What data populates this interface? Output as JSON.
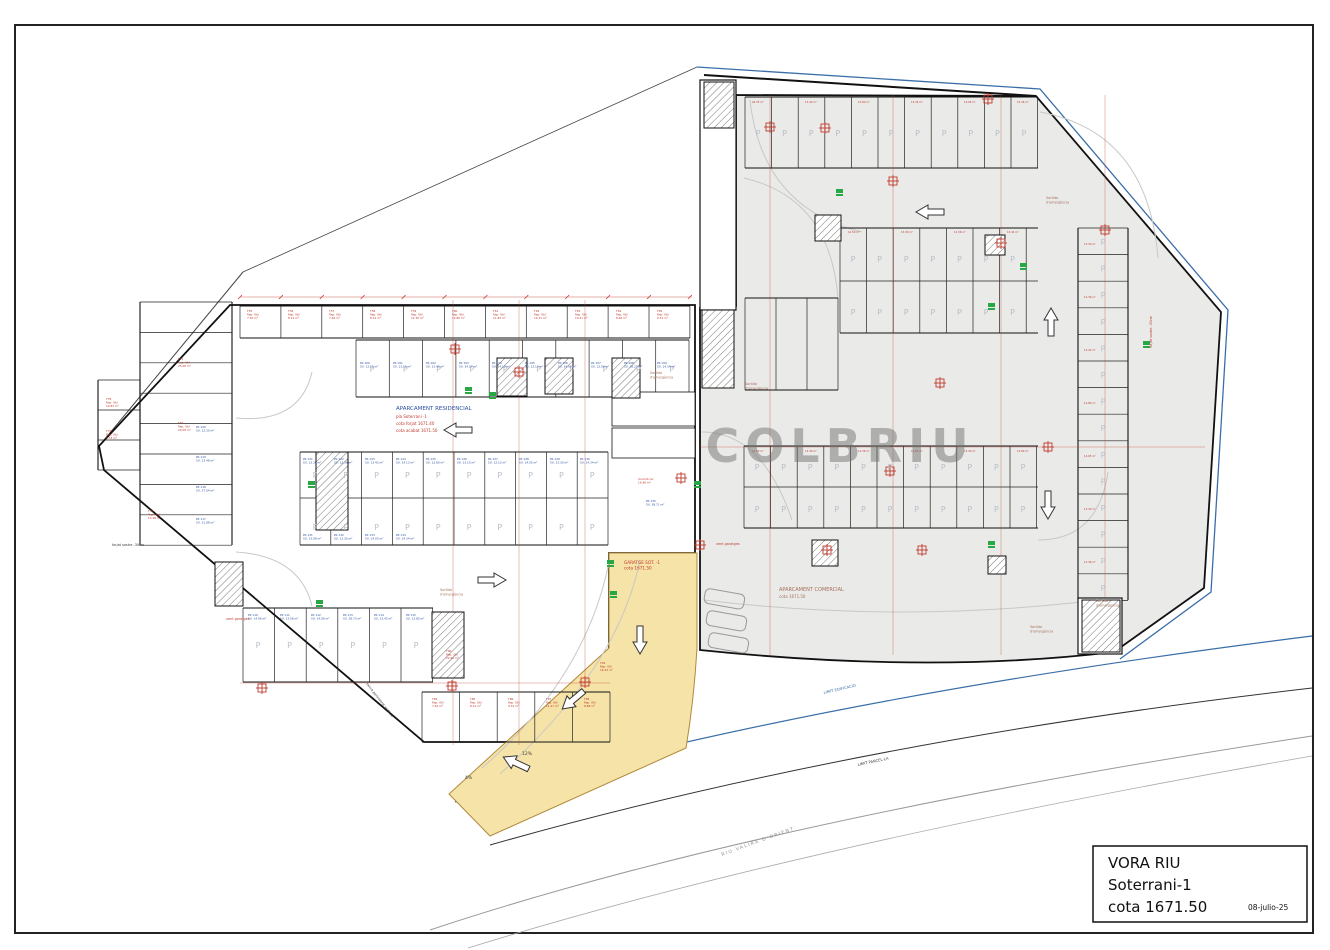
{
  "colors": {
    "blue": "#2a4fa0",
    "red": "#c03a2e",
    "brownred": "#a6705c",
    "gray": "#8f8f8f",
    "siteblue": "#3a6ea8",
    "dark": "#3a3a3a",
    "green": "#27a844",
    "ramp_yellow": "#f6e3a8",
    "commercial_fill": "#eaeae8",
    "watermark_gray": "#6f6f6f"
  },
  "title_block": {
    "project": "VORA RIU",
    "level": "Soterrani-1",
    "elevation": "cota 1671.50",
    "date": "08-julio-25"
  },
  "watermark": "COLBRIU",
  "stall_letter": "P",
  "labels": [
    {
      "n": "residential-area-title",
      "x": 396,
      "y": 410,
      "s": 5.5,
      "c": "blue",
      "L": [
        "APARCAMENT RESIDENCIAL"
      ]
    },
    {
      "n": "residential-area-plan",
      "x": 396,
      "y": 418,
      "s": 4,
      "c": "red",
      "L": [
        "pla Soterrani -1"
      ]
    },
    {
      "n": "residential-cota-forjat",
      "x": 396,
      "y": 425,
      "s": 4,
      "c": "red",
      "L": [
        "cota forjat 1671.40"
      ]
    },
    {
      "n": "residential-cota-acabat",
      "x": 396,
      "y": 432,
      "s": 4,
      "c": "red",
      "L": [
        "cota acabat 1671.50"
      ]
    },
    {
      "n": "commercial-area-title",
      "x": 779,
      "y": 591,
      "s": 5,
      "c": "brownred",
      "L": [
        "APARCAMENT COMERCIAL"
      ]
    },
    {
      "n": "commercial-area-cota",
      "x": 779,
      "y": 598,
      "s": 4,
      "c": "brownred",
      "L": [
        "cota 1671.50"
      ]
    },
    {
      "n": "ramp-area-title",
      "x": 624,
      "y": 564,
      "s": 4.2,
      "c": "red",
      "L": [
        "GARATGE SOT. -1",
        "cota 1671.50"
      ]
    },
    {
      "n": "exit-label",
      "x": 650,
      "y": 374,
      "s": 3.4,
      "c": "brownred",
      "L": [
        "Sortida",
        "d'emergència"
      ]
    },
    {
      "n": "exit-label",
      "x": 745,
      "y": 385,
      "s": 3.4,
      "c": "brownred",
      "L": [
        "Sortida",
        "d'emergència"
      ]
    },
    {
      "n": "exit-label",
      "x": 1046,
      "y": 199,
      "s": 3.4,
      "c": "brownred",
      "L": [
        "Sortida",
        "d'emergència"
      ]
    },
    {
      "n": "exit-label",
      "x": 1030,
      "y": 628,
      "s": 3.4,
      "c": "brownred",
      "L": [
        "Sortida",
        "d'emergència"
      ]
    },
    {
      "n": "exit-label",
      "x": 440,
      "y": 591,
      "s": 3.4,
      "c": "brownred",
      "L": [
        "Sortida",
        "d'emergència"
      ]
    },
    {
      "n": "exit-label",
      "x": 1096,
      "y": 602,
      "s": 3.4,
      "c": "brownred",
      "L": [
        "Sortida",
        "d'emergència"
      ]
    },
    {
      "n": "vent-label",
      "x": 716,
      "y": 545,
      "s": 3.4,
      "c": "red",
      "L": [
        "vent garatges"
      ]
    },
    {
      "n": "vent-label",
      "x": 226,
      "y": 620,
      "s": 3.4,
      "c": "red",
      "L": [
        "vent garatges"
      ]
    },
    {
      "n": "slab-note",
      "x": 112,
      "y": 546,
      "s": 3.4,
      "c": "dark",
      "L": [
        "forjat sostre -30cm"
      ]
    },
    {
      "n": "slab-note",
      "x": 1152,
      "y": 348,
      "s": 3.4,
      "c": "red",
      "r": -90,
      "L": [
        "forjat sostre -30cm"
      ]
    },
    {
      "n": "fence-note",
      "x": 366,
      "y": 684,
      "s": 3.4,
      "c": "dark",
      "r": 52,
      "L": [
        "tanca perimetral vertical"
      ]
    },
    {
      "n": "river-label",
      "x": 722,
      "y": 856,
      "s": 4.6,
      "c": "gray",
      "r": -20,
      "sp": 1.5,
      "L": [
        "RIU  VALIRA  D'ORIENT"
      ]
    },
    {
      "n": "limit-edificacio-label",
      "x": 824,
      "y": 694,
      "s": 3.8,
      "c": "siteblue",
      "r": -13,
      "L": [
        "LIMIT EDIFICACIO"
      ]
    },
    {
      "n": "limit-parcella-label",
      "x": 858,
      "y": 766,
      "s": 3.8,
      "c": "dark",
      "r": -12,
      "L": [
        "LIMIT PARCEL·LA"
      ]
    },
    {
      "n": "slope-label",
      "x": 465,
      "y": 779,
      "s": 4.5,
      "c": "dark",
      "L": [
        "4%"
      ]
    },
    {
      "n": "slope-label",
      "x": 522,
      "y": 755,
      "s": 4.5,
      "c": "dark",
      "L": [
        "12%"
      ]
    },
    {
      "n": "storage-label",
      "x": 247,
      "y": 312,
      "s": 2.8,
      "c": "red",
      "L": [
        "T55",
        "Rep. Útil",
        "7.30 m²"
      ]
    },
    {
      "n": "storage-label",
      "x": 288,
      "y": 312,
      "s": 2.8,
      "c": "red",
      "L": [
        "T56",
        "Rep. Útil",
        "8.12 m²"
      ]
    },
    {
      "n": "storage-label",
      "x": 329,
      "y": 312,
      "s": 2.8,
      "c": "red",
      "L": [
        "T57",
        "Rep. Útil",
        "7.26 m²"
      ]
    },
    {
      "n": "storage-label",
      "x": 370,
      "y": 312,
      "s": 2.8,
      "c": "red",
      "L": [
        "T58",
        "Rep. Útil",
        "8.12 m²"
      ]
    },
    {
      "n": "storage-label",
      "x": 411,
      "y": 312,
      "s": 2.8,
      "c": "red",
      "L": [
        "T59",
        "Rep. Útil",
        "12.36 m²"
      ]
    },
    {
      "n": "storage-label",
      "x": 452,
      "y": 312,
      "s": 2.8,
      "c": "red",
      "L": [
        "T60",
        "Rep. Útil",
        "12.80 m²"
      ]
    },
    {
      "n": "storage-label",
      "x": 493,
      "y": 312,
      "s": 2.8,
      "c": "red",
      "L": [
        "T61",
        "Rep. Útil",
        "11.84 m²"
      ]
    },
    {
      "n": "storage-label",
      "x": 534,
      "y": 312,
      "s": 2.8,
      "c": "red",
      "L": [
        "T62",
        "Rep. Útil",
        "14.31 m²"
      ]
    },
    {
      "n": "storage-label",
      "x": 575,
      "y": 312,
      "s": 2.8,
      "c": "red",
      "L": [
        "T63",
        "Rep. Útil",
        "10.21 m²"
      ]
    },
    {
      "n": "storage-label",
      "x": 616,
      "y": 312,
      "s": 2.8,
      "c": "red",
      "L": [
        "T64",
        "Rep. Útil",
        "8.46 m²"
      ]
    },
    {
      "n": "storage-label",
      "x": 657,
      "y": 312,
      "s": 2.8,
      "c": "red",
      "L": [
        "T65",
        "Rep. Útil",
        "9.31 m²"
      ]
    },
    {
      "n": "parking-label",
      "x": 360,
      "y": 364,
      "s": 2.8,
      "c": "blue",
      "L": [
        "PK 100",
        "SU. 12.12 m²"
      ]
    },
    {
      "n": "parking-label",
      "x": 393,
      "y": 364,
      "s": 2.8,
      "c": "blue",
      "L": [
        "PK 101",
        "SU. 13.15 m²"
      ]
    },
    {
      "n": "parking-label",
      "x": 426,
      "y": 364,
      "s": 2.8,
      "c": "blue",
      "L": [
        "PK 102",
        "SU. 13.42 m²"
      ]
    },
    {
      "n": "parking-label",
      "x": 459,
      "y": 364,
      "s": 2.8,
      "c": "blue",
      "L": [
        "PK 103",
        "SU. 24.27 m²"
      ]
    },
    {
      "n": "parking-label",
      "x": 492,
      "y": 364,
      "s": 2.8,
      "c": "blue",
      "L": [
        "PK 104",
        "SU. 14.13 m²"
      ]
    },
    {
      "n": "parking-label",
      "x": 525,
      "y": 364,
      "s": 2.8,
      "c": "blue",
      "L": [
        "PK 105",
        "SU. 12.13 m²"
      ]
    },
    {
      "n": "parking-label",
      "x": 558,
      "y": 364,
      "s": 2.8,
      "c": "blue",
      "L": [
        "PK 106",
        "SU. 14.05 m²"
      ]
    },
    {
      "n": "parking-label",
      "x": 591,
      "y": 364,
      "s": 2.8,
      "c": "blue",
      "L": [
        "PK 107",
        "SU. 12.56 m²"
      ]
    },
    {
      "n": "parking-label",
      "x": 624,
      "y": 364,
      "s": 2.8,
      "c": "blue",
      "L": [
        "PK 108",
        "SU. 16.27 m²"
      ]
    },
    {
      "n": "parking-label",
      "x": 657,
      "y": 364,
      "s": 2.8,
      "c": "blue",
      "L": [
        "PK 109",
        "SU. 14.34 m²"
      ]
    },
    {
      "n": "parking-label",
      "x": 303,
      "y": 460,
      "s": 2.8,
      "c": "blue",
      "L": [
        "PK 121",
        "SU. 13.30 m²"
      ]
    },
    {
      "n": "parking-label",
      "x": 334,
      "y": 460,
      "s": 2.8,
      "c": "blue",
      "L": [
        "PK 122",
        "SU. 12.36 m²"
      ]
    },
    {
      "n": "parking-label",
      "x": 365,
      "y": 460,
      "s": 2.8,
      "c": "blue",
      "L": [
        "PK 123",
        "SU. 13.42 m²"
      ]
    },
    {
      "n": "parking-label",
      "x": 396,
      "y": 460,
      "s": 2.8,
      "c": "blue",
      "L": [
        "PK 124",
        "SU. 14.13 m²"
      ]
    },
    {
      "n": "parking-label",
      "x": 426,
      "y": 460,
      "s": 2.8,
      "c": "blue",
      "L": [
        "PK 125",
        "SU. 12.80 m²"
      ]
    },
    {
      "n": "parking-label",
      "x": 457,
      "y": 460,
      "s": 2.8,
      "c": "blue",
      "L": [
        "PK 126",
        "SU. 13.15 m²"
      ]
    },
    {
      "n": "parking-label",
      "x": 488,
      "y": 460,
      "s": 2.8,
      "c": "blue",
      "L": [
        "PK 127",
        "SU. 12.12 m²"
      ]
    },
    {
      "n": "parking-label",
      "x": 519,
      "y": 460,
      "s": 2.8,
      "c": "blue",
      "L": [
        "PK 128",
        "SU. 14.05 m²"
      ]
    },
    {
      "n": "parking-label",
      "x": 550,
      "y": 460,
      "s": 2.8,
      "c": "blue",
      "L": [
        "PK 129",
        "SU. 13.30 m²"
      ]
    },
    {
      "n": "parking-label",
      "x": 580,
      "y": 460,
      "s": 2.8,
      "c": "blue",
      "L": [
        "PK 130",
        "SU. 14.34 m²"
      ]
    },
    {
      "n": "parking-label",
      "x": 303,
      "y": 536,
      "s": 2.8,
      "c": "blue",
      "L": [
        "PK 131",
        "SU. 13.08 m²"
      ]
    },
    {
      "n": "parking-label",
      "x": 334,
      "y": 536,
      "s": 2.8,
      "c": "blue",
      "L": [
        "PK 132",
        "SU. 12.36 m²"
      ]
    },
    {
      "n": "parking-label",
      "x": 365,
      "y": 536,
      "s": 2.8,
      "c": "blue",
      "L": [
        "PK 133",
        "SU. 14.05 m²"
      ]
    },
    {
      "n": "parking-label",
      "x": 396,
      "y": 536,
      "s": 2.8,
      "c": "blue",
      "L": [
        "PK 134",
        "SU. 14.34 m²"
      ]
    },
    {
      "n": "parking-label",
      "x": 248,
      "y": 616,
      "s": 2.8,
      "c": "blue",
      "L": [
        "PK 110",
        "SU. 14.96 m²"
      ]
    },
    {
      "n": "parking-label",
      "x": 280,
      "y": 616,
      "s": 2.8,
      "c": "blue",
      "L": [
        "PK 111",
        "SU. 13.08 m²"
      ]
    },
    {
      "n": "parking-label",
      "x": 311,
      "y": 616,
      "s": 2.8,
      "c": "blue",
      "L": [
        "PK 112",
        "SU. 14.06 m²"
      ]
    },
    {
      "n": "parking-label",
      "x": 343,
      "y": 616,
      "s": 2.8,
      "c": "blue",
      "L": [
        "PK 113",
        "SU. 28.73 m²"
      ]
    },
    {
      "n": "parking-label",
      "x": 374,
      "y": 616,
      "s": 2.8,
      "c": "blue",
      "L": [
        "PK 114",
        "SU. 13.42 m²"
      ]
    },
    {
      "n": "parking-label",
      "x": 406,
      "y": 616,
      "s": 2.8,
      "c": "blue",
      "L": [
        "PK 115",
        "SU. 12.80 m²"
      ]
    },
    {
      "n": "parking-label",
      "x": 196,
      "y": 428,
      "s": 2.8,
      "c": "blue",
      "L": [
        "PK 120",
        "SU. 12.30 m²"
      ]
    },
    {
      "n": "parking-label",
      "x": 196,
      "y": 458,
      "s": 2.8,
      "c": "blue",
      "L": [
        "PK 119",
        "SU. 13.48 m²"
      ]
    },
    {
      "n": "parking-label",
      "x": 196,
      "y": 488,
      "s": 2.8,
      "c": "blue",
      "L": [
        "PK 118",
        "SU. 27.04 m²"
      ]
    },
    {
      "n": "parking-label",
      "x": 196,
      "y": 520,
      "s": 2.8,
      "c": "blue",
      "L": [
        "PK 117",
        "SU. 21.88 m²"
      ]
    },
    {
      "n": "storage-label",
      "x": 178,
      "y": 360,
      "s": 2.8,
      "c": "red",
      "L": [
        "T75",
        "Rep. Útil",
        "25.08 m²"
      ]
    },
    {
      "n": "storage-label",
      "x": 178,
      "y": 424,
      "s": 2.8,
      "c": "red",
      "L": [
        "T76",
        "Rep. Útil",
        "20.06 m²"
      ]
    },
    {
      "n": "storage-label",
      "x": 148,
      "y": 512,
      "s": 2.8,
      "c": "red",
      "L": [
        "T77",
        "Rep. Útil",
        "13.48 m²"
      ]
    },
    {
      "n": "storage-label",
      "x": 106,
      "y": 400,
      "s": 2.8,
      "c": "red",
      "L": [
        "T78",
        "Rep. Útil",
        "10.84 m²"
      ]
    },
    {
      "n": "storage-label",
      "x": 106,
      "y": 432,
      "s": 2.8,
      "c": "red",
      "L": [
        "T79",
        "Rep. Útil",
        "8.74 m²"
      ]
    },
    {
      "n": "storage-label",
      "x": 432,
      "y": 700,
      "s": 2.8,
      "c": "red",
      "L": [
        "T84",
        "Rep. Útil",
        "7.26 m²"
      ]
    },
    {
      "n": "storage-label",
      "x": 470,
      "y": 700,
      "s": 2.8,
      "c": "red",
      "L": [
        "T85",
        "Rep. Útil",
        "8.12 m²"
      ]
    },
    {
      "n": "storage-label",
      "x": 508,
      "y": 700,
      "s": 2.8,
      "c": "red",
      "L": [
        "T86",
        "Rep. Útil",
        "9.34 m²"
      ]
    },
    {
      "n": "storage-label",
      "x": 546,
      "y": 700,
      "s": 2.8,
      "c": "red",
      "L": [
        "T87",
        "Rep. Útil",
        "11.47 m²"
      ]
    },
    {
      "n": "storage-label",
      "x": 584,
      "y": 700,
      "s": 2.8,
      "c": "red",
      "L": [
        "T88",
        "Rep. Útil",
        "8.88 m²"
      ]
    },
    {
      "n": "storage-label",
      "x": 446,
      "y": 652,
      "s": 2.8,
      "c": "red",
      "L": [
        "T90",
        "Rep. Útil",
        "22.92 m²"
      ]
    },
    {
      "n": "storage-label",
      "x": 600,
      "y": 664,
      "s": 2.8,
      "c": "red",
      "L": [
        "T94",
        "Rep. Útil",
        "16.43 m²"
      ]
    },
    {
      "n": "parking-label",
      "x": 646,
      "y": 502,
      "s": 2.8,
      "c": "blue",
      "L": [
        "PK 135",
        "SU. 38.71 m²"
      ]
    },
    {
      "n": "room-label",
      "x": 638,
      "y": 480,
      "s": 2.8,
      "c": "red",
      "L": [
        "local tècnic",
        "16.96 m²"
      ]
    },
    {
      "n": "stall-area-label",
      "x": 752,
      "y": 103,
      "s": 2.6,
      "c": "red",
      "L": [
        "26.35 m²"
      ]
    },
    {
      "n": "stall-area-label",
      "x": 805,
      "y": 103,
      "s": 2.6,
      "c": "red",
      "L": [
        "13.30 m²"
      ]
    },
    {
      "n": "stall-area-label",
      "x": 858,
      "y": 103,
      "s": 2.6,
      "c": "red",
      "L": [
        "12.80 m²"
      ]
    },
    {
      "n": "stall-area-label",
      "x": 911,
      "y": 103,
      "s": 2.6,
      "c": "red",
      "L": [
        "13.30 m²"
      ]
    },
    {
      "n": "stall-area-label",
      "x": 964,
      "y": 103,
      "s": 2.6,
      "c": "red",
      "L": [
        "14.05 m²"
      ]
    },
    {
      "n": "stall-area-label",
      "x": 1017,
      "y": 103,
      "s": 2.6,
      "c": "red",
      "L": [
        "15.26 m²"
      ]
    },
    {
      "n": "stall-area-label",
      "x": 848,
      "y": 233,
      "s": 2.6,
      "c": "red",
      "L": [
        "12.50 m²"
      ]
    },
    {
      "n": "stall-area-label",
      "x": 901,
      "y": 233,
      "s": 2.6,
      "c": "red",
      "L": [
        "13.30 m²"
      ]
    },
    {
      "n": "stall-area-label",
      "x": 954,
      "y": 233,
      "s": 2.6,
      "c": "red",
      "L": [
        "12.36 m²"
      ]
    },
    {
      "n": "stall-area-label",
      "x": 1007,
      "y": 233,
      "s": 2.6,
      "c": "red",
      "L": [
        "13.42 m²"
      ]
    },
    {
      "n": "stall-area-label",
      "x": 752,
      "y": 452,
      "s": 2.6,
      "c": "red",
      "L": [
        "12.80 m²"
      ]
    },
    {
      "n": "stall-area-label",
      "x": 805,
      "y": 452,
      "s": 2.6,
      "c": "red",
      "L": [
        "13.30 m²"
      ]
    },
    {
      "n": "stall-area-label",
      "x": 858,
      "y": 452,
      "s": 2.6,
      "c": "red",
      "L": [
        "12.36 m²"
      ]
    },
    {
      "n": "stall-area-label",
      "x": 911,
      "y": 452,
      "s": 2.6,
      "c": "red",
      "L": [
        "14.05 m²"
      ]
    },
    {
      "n": "stall-area-label",
      "x": 964,
      "y": 452,
      "s": 2.6,
      "c": "red",
      "L": [
        "13.30 m²"
      ]
    },
    {
      "n": "stall-area-label",
      "x": 1017,
      "y": 452,
      "s": 2.6,
      "c": "red",
      "L": [
        "12.80 m²"
      ]
    },
    {
      "n": "stall-area-label",
      "x": 1084,
      "y": 245,
      "s": 2.6,
      "c": "red",
      "L": [
        "13.30 m²"
      ]
    },
    {
      "n": "stall-area-label",
      "x": 1084,
      "y": 298,
      "s": 2.6,
      "c": "red",
      "L": [
        "12.36 m²"
      ]
    },
    {
      "n": "stall-area-label",
      "x": 1084,
      "y": 351,
      "s": 2.6,
      "c": "red",
      "L": [
        "13.42 m²"
      ]
    },
    {
      "n": "stall-area-label",
      "x": 1084,
      "y": 404,
      "s": 2.6,
      "c": "red",
      "L": [
        "12.80 m²"
      ]
    },
    {
      "n": "stall-area-label",
      "x": 1084,
      "y": 457,
      "s": 2.6,
      "c": "red",
      "L": [
        "14.05 m²"
      ]
    },
    {
      "n": "stall-area-label",
      "x": 1084,
      "y": 510,
      "s": 2.6,
      "c": "red",
      "L": [
        "13.30 m²"
      ]
    },
    {
      "n": "stall-area-label",
      "x": 1084,
      "y": 563,
      "s": 2.6,
      "c": "red",
      "L": [
        "12.36 m²"
      ]
    }
  ]
}
